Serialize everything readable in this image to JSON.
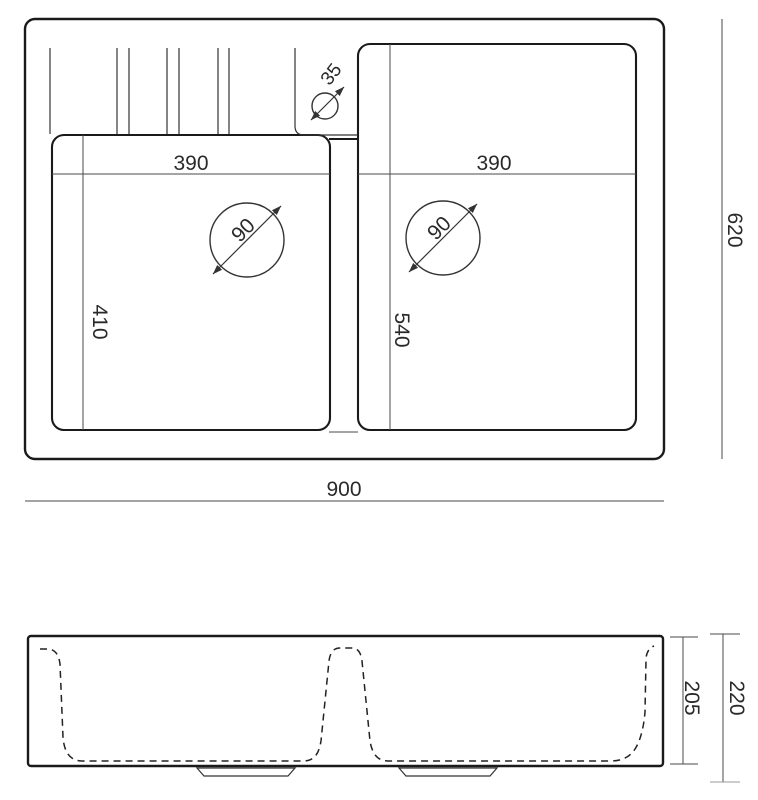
{
  "drawing_title": "Double-bowl kitchen sink dimensional drawing, top view and front elevation",
  "dims": {
    "overall_width": "900",
    "overall_depth": "620",
    "left_bowl_width": "390",
    "right_bowl_width": "390",
    "left_bowl_depth": "410",
    "right_bowl_depth": "540",
    "left_drain_diameter": "90",
    "right_drain_diameter": "90",
    "faucet_hole_diameter": "35",
    "front_overall_height": "220",
    "front_inner_depth": "205"
  },
  "colors": {
    "outline": "#1a1a1a",
    "thin_line": "#333333",
    "dimension_line": "#4a4a4a",
    "text": "#2a2a2a",
    "background": "#ffffff"
  }
}
